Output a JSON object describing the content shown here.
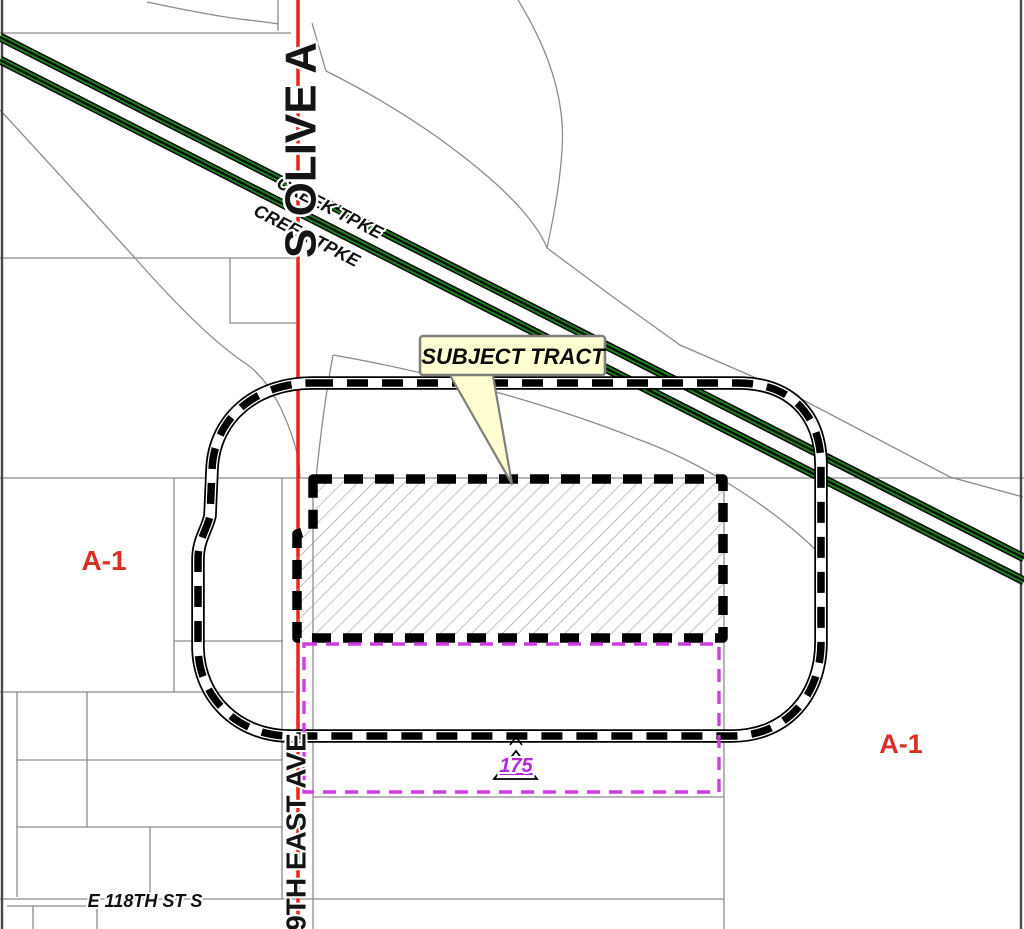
{
  "map": {
    "callout": {
      "label": "SUBJECT TRACT"
    },
    "roads": {
      "olive_ave_vertical": "S OLIVE A",
      "east_ave_vertical": "9TH EAST AVE",
      "turnpike_label_1": "CREEK TPKE",
      "turnpike_label_2": "CREEK TPKE",
      "e_118th_st": "E 118TH ST S"
    },
    "zoning": {
      "left_label": "A-1",
      "right_label": "A-1"
    },
    "case_marker": {
      "number": "175"
    },
    "colors": {
      "road_red": "#E8251C",
      "turnpike_green": "#1E7A1E",
      "case_boundary_purple": "#CC3EE0",
      "case_number_purple": "#B327D6",
      "zoning_red": "#D93025",
      "callout_fill": "#FFFFD2",
      "callout_border": "#7F7F7F",
      "parcel_gray": "#8C8C8C",
      "boundary_black": "#000000"
    }
  }
}
